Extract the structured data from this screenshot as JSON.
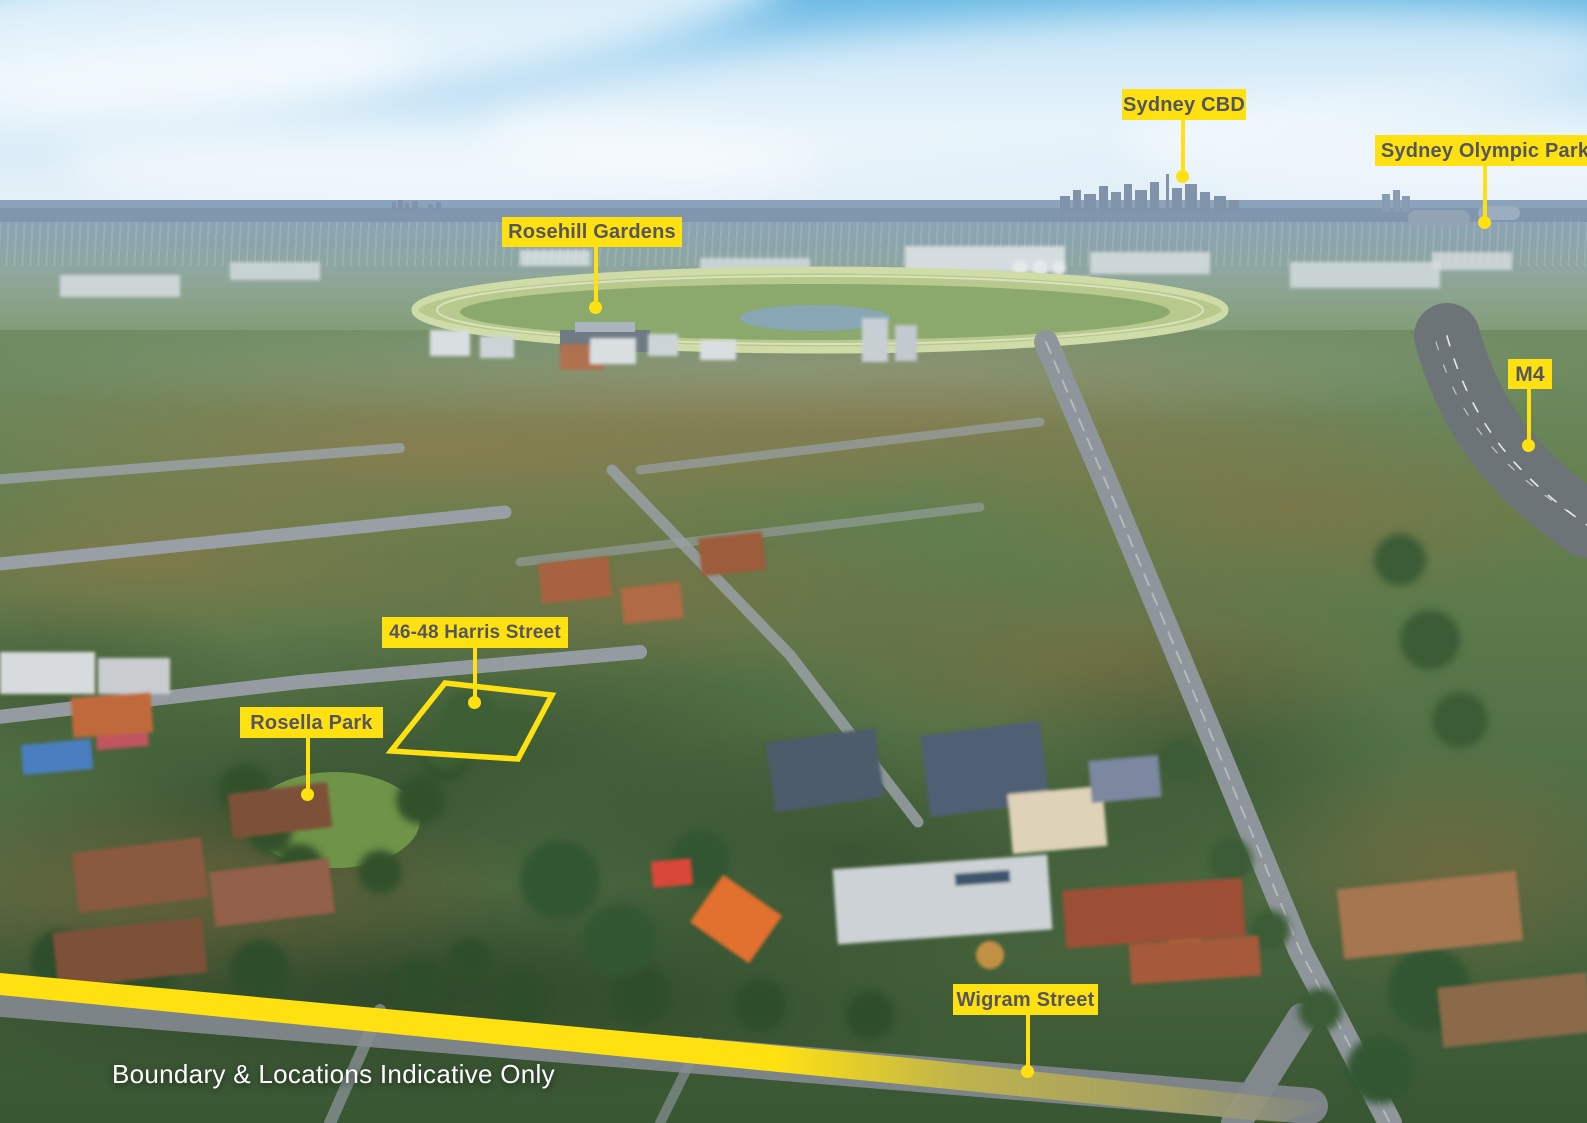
{
  "image_type": "aerial-photograph-with-location-callouts",
  "colors": {
    "accent_yellow": "#FFE112",
    "label_text": "#54565B",
    "disclaimer_text": "#FFFFFF"
  },
  "annotations": {
    "sydney_cbd": "Sydney CBD",
    "sydney_olympic_park": "Sydney Olympic Park",
    "rosehill_gardens": "Rosehill Gardens",
    "m4_motorway": "M4",
    "property_address": "46-48 Harris Street",
    "rosella_park": "Rosella Park",
    "wigram_street": "Wigram Street"
  },
  "disclaimer": "Boundary & Locations Indicative Only"
}
